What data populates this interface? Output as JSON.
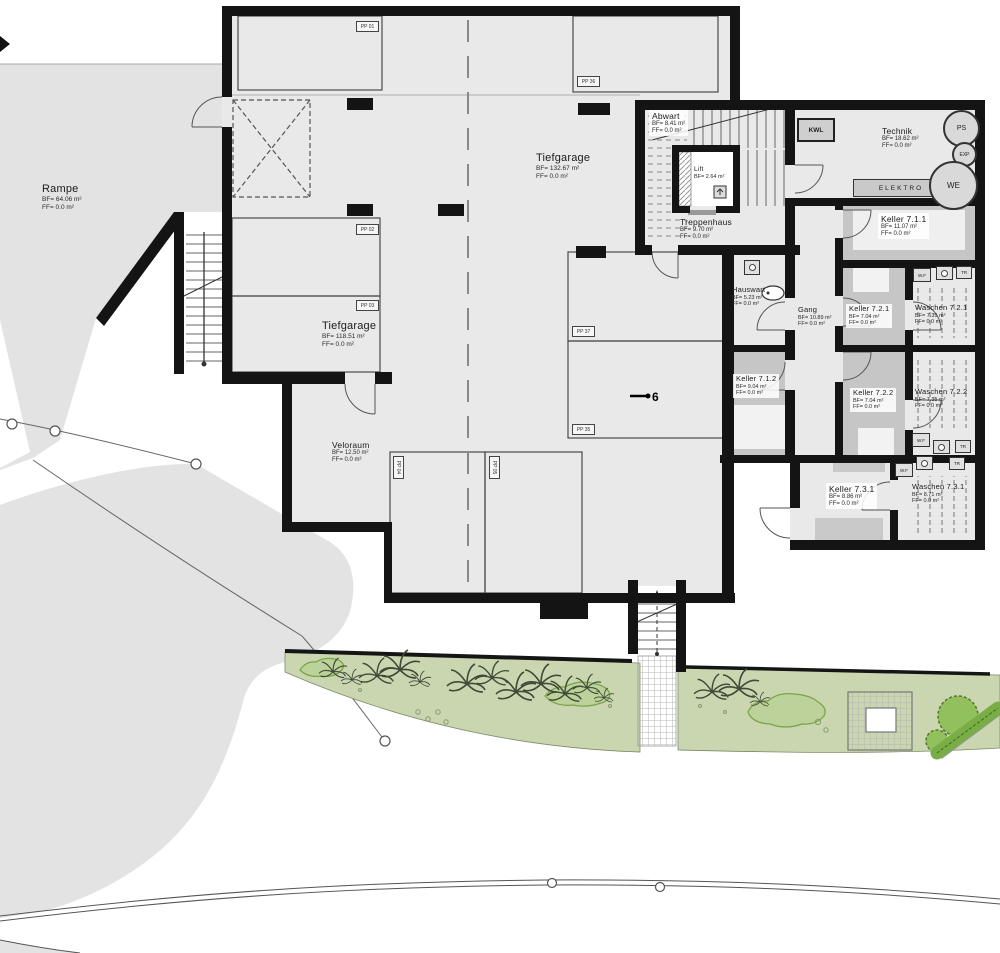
{
  "drawing": {
    "type": "Untergeschoss Grundriss (basement floor plan)"
  },
  "rooms": {
    "rampe": {
      "name": "Rampe",
      "bf": "BF= 64.06 m²",
      "ff": "FF= 0.0 m²"
    },
    "tiefgarage_main": {
      "name": "Tiefgarage",
      "bf": "BF= 132.67 m²",
      "ff": "FF= 0.0 m²"
    },
    "tiefgarage_left": {
      "name": "Tiefgarage",
      "bf": "BF= 118.51 m²",
      "ff": "FF= 0.0 m²"
    },
    "veloraum": {
      "name": "Veloraum",
      "bf": "BF= 12.50 m²",
      "ff": "FF= 0.0 m²"
    },
    "abwart": {
      "name": "Abwart",
      "bf": "BF= 8.41 m²",
      "ff": "FF= 0.0 m²"
    },
    "lift": {
      "name": "Lift",
      "bf": "BF= 2.64 m²"
    },
    "treppenhaus": {
      "name": "Treppenhaus",
      "bf": "BF= 9.70 m²",
      "ff": "FF= 0.0 m²"
    },
    "technik": {
      "name": "Technik",
      "bf": "BF= 18.62 m²",
      "ff": "FF= 0.0 m²"
    },
    "keller711": {
      "name": "Keller 7.1.1",
      "bf": "BF= 11.07 m²",
      "ff": "FF= 0.0 m²"
    },
    "hauswart": {
      "name": "Hauswart",
      "bf": "BF= 5.23 m²",
      "ff": "FF= 0.0 m²"
    },
    "gang": {
      "name": "Gang",
      "bf": "BF= 10.89 m²",
      "ff": "FF= 0.0 m²"
    },
    "keller721": {
      "name": "Keller 7.2.1",
      "bf": "BF= 7.04 m²",
      "ff": "FF= 0.0 m²"
    },
    "waschen721": {
      "name": "Waschen 7.2.1",
      "bf": "BF= 7.35 m²",
      "ff": "FF= 0.0 m²"
    },
    "keller712": {
      "name": "Keller 7.1.2",
      "bf": "BF= 9.04 m²",
      "ff": "FF= 0.0 m²"
    },
    "keller722": {
      "name": "Keller 7.2.2",
      "bf": "BF= 7.04 m²",
      "ff": "FF= 0.0 m²"
    },
    "waschen722": {
      "name": "Waschen 7.2.2",
      "bf": "BF= 7.35 m²",
      "ff": "FF= 0.0 m²"
    },
    "keller731": {
      "name": "Keller 7.3.1",
      "bf": "BF= 8.86 m²",
      "ff": "FF= 0.0 m²"
    },
    "waschen731": {
      "name": "Waschen 7.3.1",
      "bf": "BF= 8.71 m²",
      "ff": "FF= 0.0 m²"
    }
  },
  "parking": {
    "pp01": "PP 01",
    "pp02": "PP 02",
    "pp03": "PP 03",
    "pp04": "PP 04",
    "pp05": "PP 05",
    "pp35": "PP 35",
    "pp36": "PP 36",
    "pp37": "PP 37"
  },
  "equipment": {
    "kwl": "KWL",
    "elektro": "ELEKTRO",
    "ps": "PS",
    "exp": "EXP",
    "we": "WE",
    "wf": "W.F",
    "tr": "TR"
  },
  "annotations": {
    "drain_label": "6"
  },
  "colors": {
    "wall": "#141414",
    "floor": "#e9e9e9",
    "terrain": "#e3e3e3",
    "keller_fill": "#c6c6c6",
    "green": "#c9d6b0",
    "bush_green": "#92c05c"
  }
}
